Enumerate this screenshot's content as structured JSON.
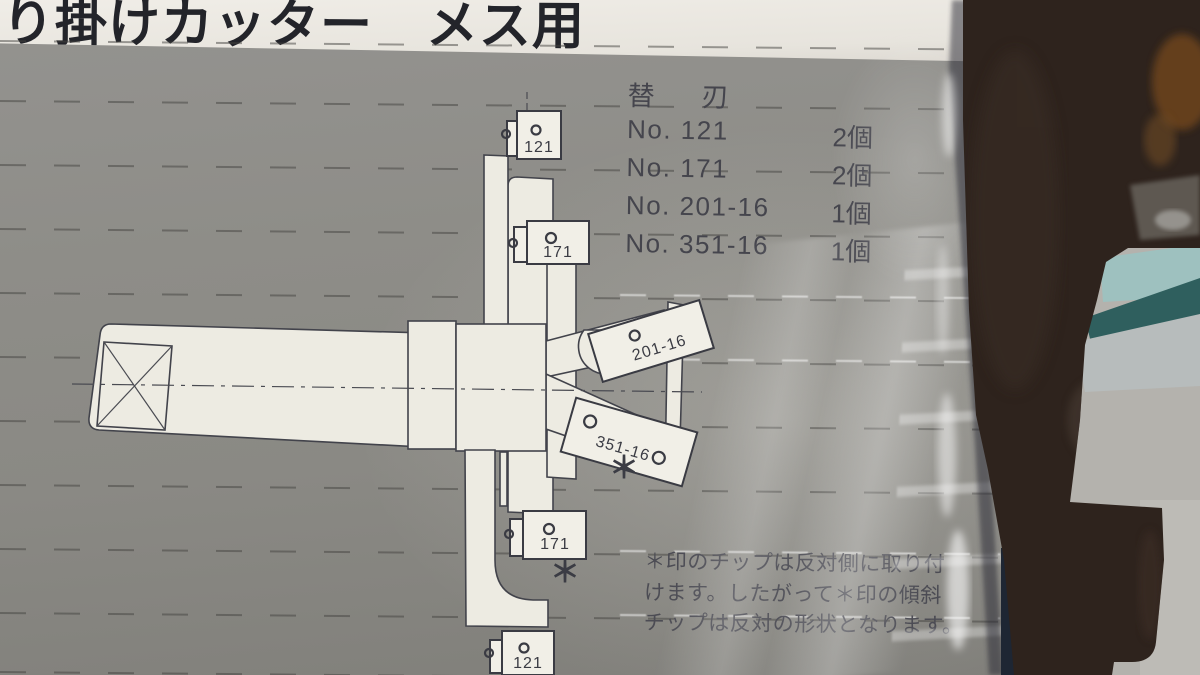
{
  "title": {
    "heading": "り掛けカッター　メス用"
  },
  "parts_list": {
    "heading": "替　刃",
    "items": [
      {
        "no": "No. 121",
        "qty": "2個"
      },
      {
        "no": "No. 171",
        "qty": "2個"
      },
      {
        "no": "No. 201-16",
        "qty": "1個"
      },
      {
        "no": "No. 351-16",
        "qty": "1個"
      }
    ]
  },
  "diagram": {
    "blade_labels": {
      "top": "121",
      "upper": "171",
      "right_upper": "201-16",
      "right_lower": "351-16",
      "lower": "171",
      "bottom": "121"
    },
    "asterisk": "＊"
  },
  "note": {
    "lines": [
      "＊印のチップは反対側に取り付",
      "けます。したがって＊印の傾斜",
      "チップは反対の形状となります。"
    ]
  },
  "colors": {
    "paper": "#8d8c87",
    "title_band": "#eae7e1",
    "ink": "#3c3d45",
    "drawing_fill": "#edebe2",
    "tool_brown": "#2e231d",
    "rust": "#6e451f",
    "teal_light": "#9ec1bf",
    "teal_dark": "#2f5f5e"
  }
}
